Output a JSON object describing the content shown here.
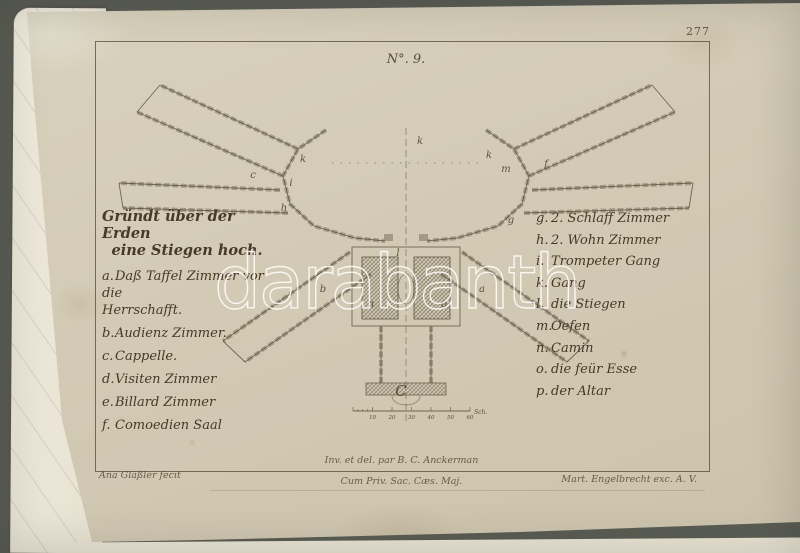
{
  "colors": {
    "background": "#5a5d54",
    "paper": "#d2cab4",
    "under_paper": "#ece7d8",
    "ink": "#493e2b",
    "wall_gray": "#938b74",
    "watermark_white": "#ffffff"
  },
  "plate": {
    "page_number": "277",
    "figure_label": "N°. 9."
  },
  "legend_left": {
    "title": [
      "Gründt über der Erden",
      "eine Stiegen hoch."
    ],
    "items": [
      {
        "key": "a.",
        "text": "Daß Taffel Zimmer vor die",
        "text2": "Herrschafft."
      },
      {
        "key": "b.",
        "text": "Audienz Zimmer."
      },
      {
        "key": "c.",
        "text": "Cappelle."
      },
      {
        "key": "d.",
        "text": "Visiten Zimmer"
      },
      {
        "key": "e.",
        "text": "Billard Zimmer"
      },
      {
        "key": "f.",
        "text": "Comoedien Saal"
      }
    ]
  },
  "legend_right": {
    "items": [
      {
        "key": "g.",
        "text": "2. Schlaff Zimmer"
      },
      {
        "key": "h.",
        "text": "2. Wohn Zimmer"
      },
      {
        "key": "i.",
        "text": "Trompeter Gang"
      },
      {
        "key": "k.",
        "text": "Gang"
      },
      {
        "key": "l.",
        "text": "die Stiegen"
      },
      {
        "key": "m.",
        "text": "Oefen"
      },
      {
        "key": "n.",
        "text": "Camin"
      },
      {
        "key": "o.",
        "text": "die feür Esse"
      },
      {
        "key": "p.",
        "text": "der Altar"
      }
    ]
  },
  "plan": {
    "labels": [
      {
        "ch": "c",
        "x": 253,
        "y": 178
      },
      {
        "ch": "k",
        "x": 303,
        "y": 162
      },
      {
        "ch": "i",
        "x": 291,
        "y": 186
      },
      {
        "ch": "h",
        "x": 284,
        "y": 211
      },
      {
        "ch": "k",
        "x": 420,
        "y": 144
      },
      {
        "ch": "k",
        "x": 489,
        "y": 158
      },
      {
        "ch": "m",
        "x": 506,
        "y": 172
      },
      {
        "ch": "f",
        "x": 546,
        "y": 167
      },
      {
        "ch": "g",
        "x": 511,
        "y": 223
      },
      {
        "ch": "b",
        "x": 323,
        "y": 292
      },
      {
        "ch": "a",
        "x": 482,
        "y": 292
      },
      {
        "ch": "l",
        "x": 398,
        "y": 256
      },
      {
        "ch": "n",
        "x": 371,
        "y": 307
      },
      {
        "ch": "o",
        "x": 444,
        "y": 307
      },
      {
        "ch": "C",
        "x": 401,
        "y": 396,
        "big": true
      }
    ]
  },
  "scale": {
    "ticks": [
      "10",
      "20",
      "30",
      "40",
      "50",
      "60"
    ],
    "unit": "Sch."
  },
  "credits": {
    "inventor": "Inv. et del. par B. C. Anckerman",
    "privilege": "Cum Priv. Sac. Cæs. Maj.",
    "engraver": "Ana Gläßler fecit",
    "publisher": "Mart. Engelbrecht exc. A. V."
  },
  "watermark": {
    "text": "darabanth"
  }
}
